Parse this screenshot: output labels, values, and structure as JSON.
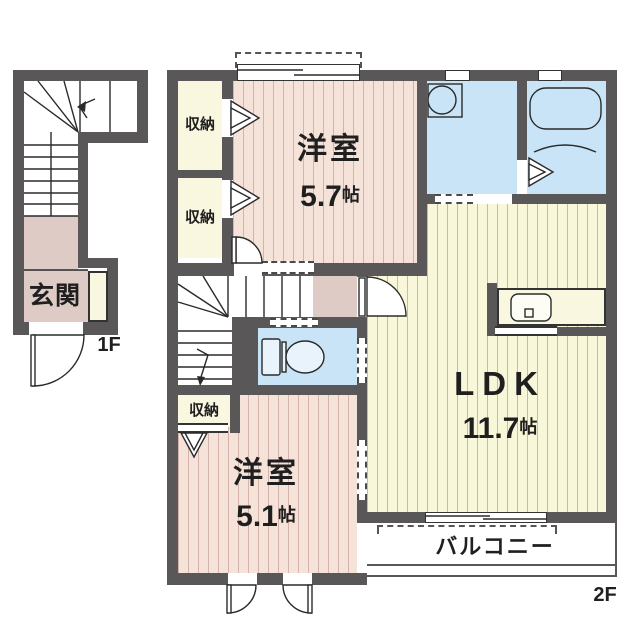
{
  "plan": {
    "floor_1f": {
      "entrance_label": "玄関",
      "floor_tag": "1F"
    },
    "floor_2f": {
      "storage_label": "収納",
      "bedroom1_name": "洋室",
      "bedroom1_size": "5.7",
      "bedroom2_name": "洋室",
      "bedroom2_size": "5.1",
      "ldk_name": "LDK",
      "ldk_size": "11.7",
      "size_unit": "帖",
      "balcony_label": "バルコニー",
      "floor_tag": "2F"
    },
    "colors": {
      "wall": "#595757",
      "bedroom_floor": "#f5e3da",
      "ldk_floor": "#f9f7d9",
      "storage_floor": "#faf7e0",
      "wet_area_floor": "#c8e4f6",
      "hall_floor": "#decbc6",
      "balcony_floor": "#ffffff"
    }
  }
}
